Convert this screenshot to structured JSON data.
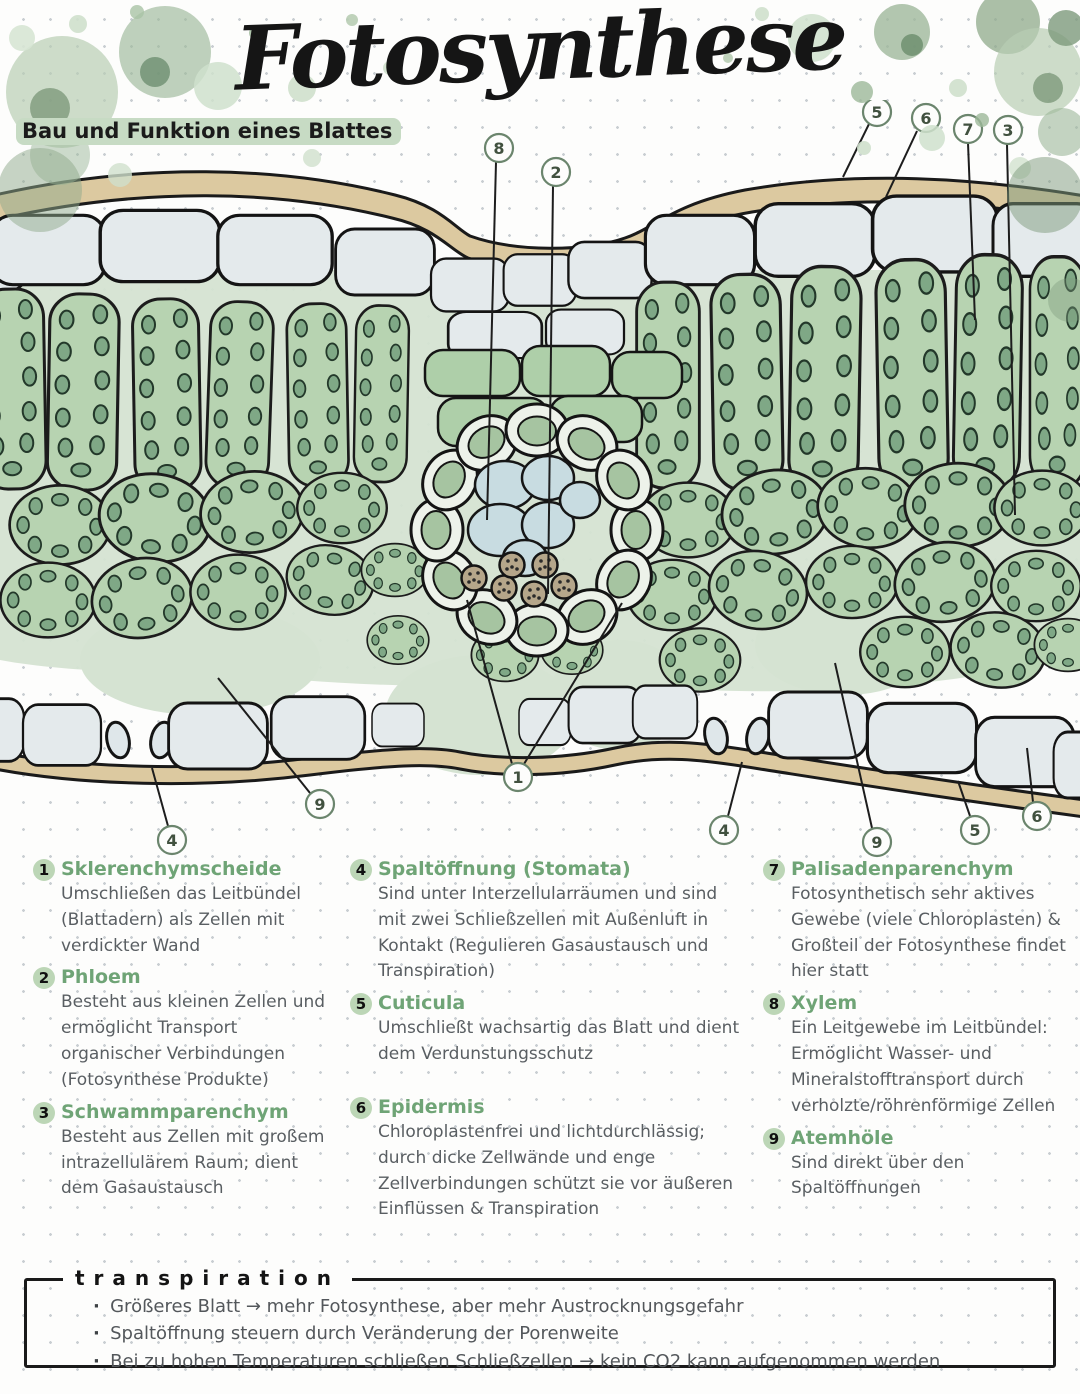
{
  "page": {
    "title": "Fotosynthese",
    "subtitle": "Bau und Funktion eines Blattes"
  },
  "diagram": {
    "description": "Querschnitt eines Blattes (leaf cross-section)",
    "callouts_top": [
      "8",
      "2",
      "5",
      "6",
      "7",
      "3"
    ],
    "callouts_bottom": [
      "4",
      "9",
      "1",
      "4",
      "9",
      "5",
      "6"
    ]
  },
  "legend": {
    "columns": [
      {
        "items": [
          {
            "number": "1",
            "title": "Sklerenchymscheide",
            "body": "Umschließen das Leitbündel (Blattadern) als Zellen mit verdickter Wand"
          },
          {
            "number": "2",
            "title": "Phloem",
            "body": "Besteht aus kleinen Zellen und ermöglicht Transport organischer Verbindungen (Fotosynthese Produkte)"
          },
          {
            "number": "3",
            "title": "Schwammparenchym",
            "body": "Besteht aus Zellen mit großem intrazellulärem Raum; dient dem Gasaustausch"
          }
        ]
      },
      {
        "items": [
          {
            "number": "4",
            "title": "Spaltöffnung (Stomata)",
            "body": "Sind unter Interzellularräumen und sind mit zwei Schließzellen mit Außenluft in Kontakt (Regulieren Gasaustausch und Transpiration)"
          },
          {
            "number": "5",
            "title": "Cuticula",
            "body": "Umschließt wachsartig das Blatt und dient dem Verdunstungsschutz"
          },
          {
            "number": "6",
            "title": "Epidermis",
            "body": "Chloroplastenfrei und lichtdurchlässig; durch dicke Zellwände und enge Zellverbindungen schützt sie vor äußeren Einflüssen & Transpiration"
          }
        ]
      },
      {
        "items": [
          {
            "number": "7",
            "title": "Palisadenparenchym",
            "body": "Fotosynthetisch sehr aktives Gewebe (viele Chloroplasten) & Großteil der Fotosynthese findet hier statt"
          },
          {
            "number": "8",
            "title": "Xylem",
            "body": "Ein Leitgewebe im Leitbündel: Ermöglicht Wasser- und Mineralstofftransport durch verholzte/röhrenförmige Zellen"
          },
          {
            "number": "9",
            "title": "Atemhöle",
            "body": "Sind direkt über den Spaltöffnungen"
          }
        ]
      }
    ]
  },
  "transpiration": {
    "title": "transpiration",
    "bullets": [
      "Größeres Blatt → mehr Fotosynthese, aber mehr Austrocknungsgefahr",
      "Spaltöffnung steuern durch Veränderung der Porenweite",
      "Bei zu hohen Temperaturen schließen Schließzellen → kein CO2 kann aufgenommen werden"
    ]
  },
  "colors": {
    "heading_green": "#6fa476",
    "badge_green": "#bcd6b6",
    "highlight_green": "#c7dbc4",
    "cell_green": "#b7d3b1",
    "chloroplast_green": "#7fa886",
    "cuticula_tan": "#dcc9a0",
    "epidermis_blue": "#e4eaec",
    "xylem_blue": "#c8dce1",
    "phloem_brown": "#b5a68a",
    "body_text": "#595e62",
    "title_black": "#151515"
  }
}
